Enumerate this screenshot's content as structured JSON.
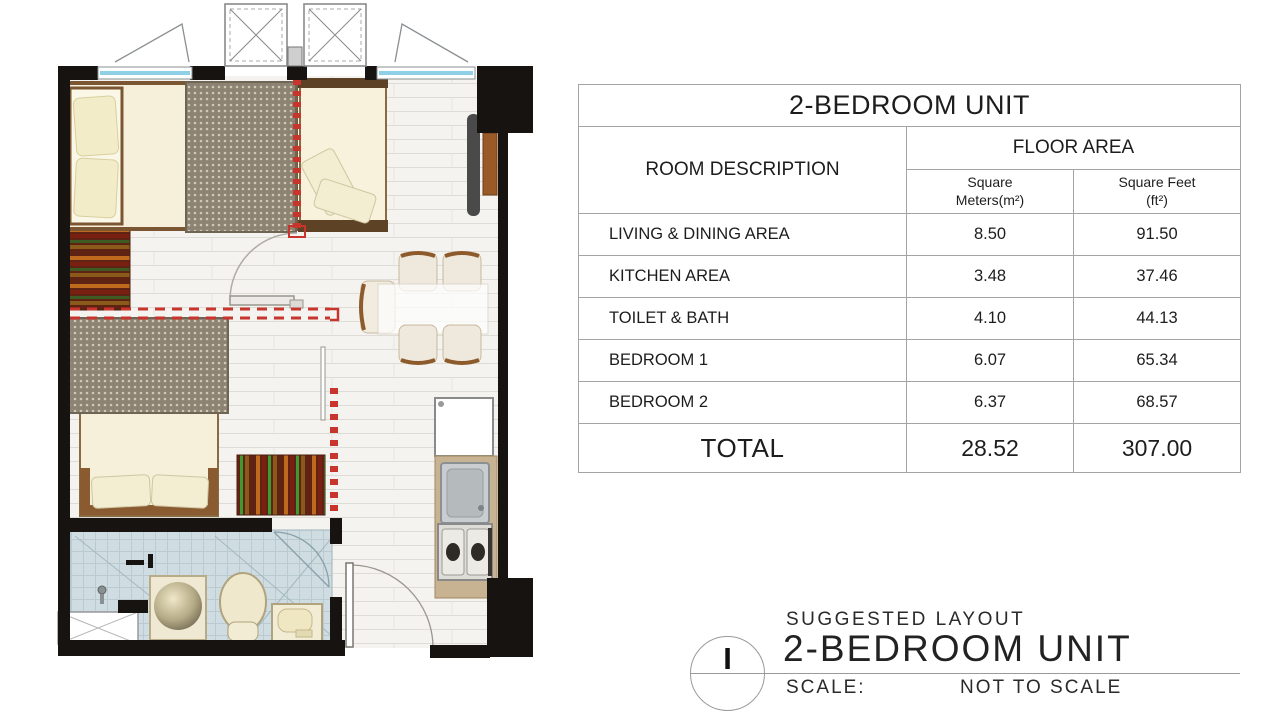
{
  "table": {
    "title": "2-BEDROOM UNIT",
    "col_room": "ROOM DESCRIPTION",
    "col_floor_area": "FLOOR AREA",
    "col_sqm": "Square Meters(m²)",
    "col_sqft": "Square Feet (ft²)",
    "rows": [
      {
        "name": "LIVING & DINING AREA",
        "sqm": "8.50",
        "sqft": "91.50"
      },
      {
        "name": "KITCHEN AREA",
        "sqm": "3.48",
        "sqft": "37.46"
      },
      {
        "name": "TOILET & BATH",
        "sqm": "4.10",
        "sqft": "44.13"
      },
      {
        "name": "BEDROOM 1",
        "sqm": "6.07",
        "sqft": "65.34"
      },
      {
        "name": "BEDROOM 2",
        "sqm": "6.37",
        "sqft": "68.57"
      }
    ],
    "total": {
      "label": "TOTAL",
      "sqm": "28.52",
      "sqft": "307.00"
    }
  },
  "title_block": {
    "drawing_number": "I",
    "label_small": "SUGGESTED LAYOUT",
    "label_large": "2-BEDROOM UNIT",
    "scale_label": "SCALE:",
    "scale_value": "NOT TO SCALE"
  },
  "floor_plan_colors": {
    "wall": "#161311",
    "window_glass": "#8fd0e6",
    "suggested_partition_dashed": "#c8352c",
    "duvet": "#8c8373",
    "bed_sheet": "#f6f0da",
    "wood_frame": "#7a5632",
    "floor_plank": "#f4f3f0",
    "bath_tile": "#cfdde2",
    "kitchen_counter": "#c7b392",
    "rug_red": "#7a2012"
  }
}
